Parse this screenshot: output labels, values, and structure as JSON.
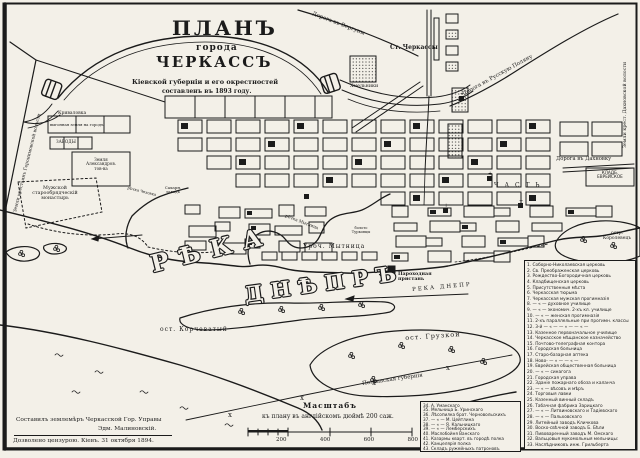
{
  "title": {
    "plan": "ПЛАНЪ",
    "goroda": "города",
    "cherkassy": "ЧЕРКАССЪ",
    "sub1": "Кіевской губерніи и его окрестностей",
    "sub2": "составленъ въ 1893 году."
  },
  "labels": {
    "road_verguny": "Дорога въ Вергуны",
    "road_polyana": "Дорога въ Русскую Поляну",
    "road_dakhnovka": "Дорога въ Дахновку",
    "dakh_volost": "Земли крест. Дахновской волости",
    "geronimov": "Земли крестьянъ Геронимовской волости",
    "station": "Ст. Черкассы",
    "khmelniki": "Хмельники",
    "krivalovka": "Криваловка",
    "vygon": "выгонная земля на городъ",
    "zavody": "ЗАВОДЫ",
    "alexandrov": "Земля\nАлександров.\nтов-ва",
    "monastery": "Мужской\nстарообрядческій\nмонастырь",
    "sugar": "Сахарн.\nзаводъ",
    "chekhovka": "рѣчка Чеховка",
    "rechka_mytnitsa": "рѣчка Мытница",
    "boloto": "болото\nТурковцы",
    "uroch": "Уроч.   Мытница",
    "chast": "Ч А С Т Ь",
    "cemetery": "КЛАДБ.\nЕВРЕЙСКОЕ",
    "reka": "РѢКА",
    "dnepr": "ДНѢПРЪ",
    "korchevaty": "ост. Корчеватый",
    "pier": "Пароходная\nпристань",
    "dnepr_small": "РЕКА  ДНЕПР",
    "gruzkoy": "ост. Грузкой",
    "korolevets": "остр.\nКоролевецъ",
    "poltava": "Полтавская губернія"
  },
  "legend_main": {
    "items": [
      "1. Соборно-Николаевская церковь",
      "2. Св. Преображенская церковь",
      "3. Рождество-Богородичная церковь",
      "4. Кладбищенская церковь",
      "5. Присутственныя мѣста",
      "6. Черкасская тюрьма",
      "7. Черкасская мужская прогимназія",
      "8. — « — духовное училище",
      "9. — « — экономич. 2-хъ кл. училище",
      "10. — « — женская прогимназія",
      "11. 2-хъ параллельные при прогимн. классы",
      "12. 3-й — « — — « — — « —",
      "13. Казенное первоначальное училище",
      "14. Черкасское мѣщанское казначейство",
      "15. Почтово-телеграфная контора",
      "16. Городская больница",
      "17. Старо-базарная аптека",
      "18. Ново- — « — — « —",
      "19. Еврейская общественная больница",
      "20. — « — синагога",
      "21. Городская управа",
      "22. Зданіе пожарнаго обоза и каланча",
      "23. — « — вѣсовъ и мѣръ",
      "24. Торговыя лавки",
      "25. Казенный винный складъ",
      "26. Табачная фабрика Зарицкаго",
      "27. — « — Литвиновскаго и Тадіевскаго",
      "28. — « — Пальховскаго",
      "29. Литейный заводъ Кличкова",
      "30. Воско-свѣчной заводъ Б. Бѣли",
      "31. Пивоваренный заводъ М. Омскаго",
      "32. Вальцовыя мукомольныя мельницы:",
      "33. Наслѣдниковъ инж. Грильберта"
    ]
  },
  "legend_extra": {
    "items": [
      "34. А. Уманскаго",
      "35. Мельница Б. Уринскаго",
      "36. Лѣсопилка брат. Черновольскихъ",
      "37. — « — М. Цейтлина",
      "38. — « — Я. Кальницкаго",
      "39. — « — Лемберскихъ",
      "40. Маслобойня Ванскаго",
      "41. Казармы кварт. въ городѣ полка",
      "42. Канцелярія полка",
      "43. Складъ ружейныхъ патроновъ"
    ]
  },
  "scale": {
    "title": "Масштабъ",
    "caption": "къ плану въ англійскомъ дюймѣ 200 саж.",
    "ticks": [
      "200",
      "400",
      "600",
      "800"
    ]
  },
  "credits": {
    "line1": "Составилъ землемѣръ Черкасской Гор. Управы",
    "line2": "Эдм. Малиновскій.",
    "line3": "Дозволено цензурою. Кіевъ. 31 октября 1894."
  }
}
